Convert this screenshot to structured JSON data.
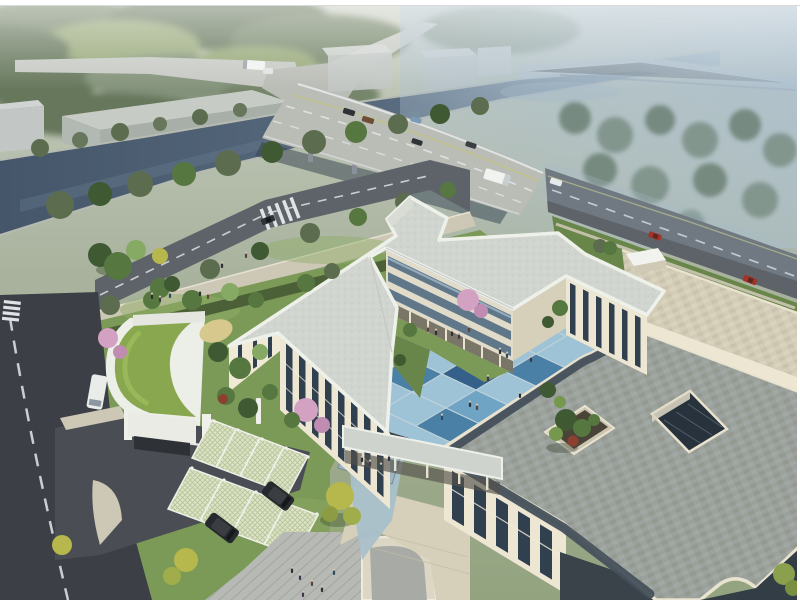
{
  "image": {
    "kind": "architectural aerial rendering",
    "description": "Bird's-eye perspective rendering of a three-story cream campus building with a blue checkerboard courtyard, grey paved roofs with skylight atrium and rooftop planter, curved green-roof gatehouse, grass-grid parking, beside a canal crossed by a curving boulevard bridge; misty trees and a distant viaduct fill the background.",
    "width_px": 800,
    "height_px": 600
  },
  "palette": {
    "fogTop": "#ccd2c5",
    "fogLow": "#a7b19c",
    "fieldFar": "#97a878",
    "treeFar1": "#76866b",
    "treeFar2": "#66775c",
    "treeFar3": "#83927a",
    "hazeBlue": "#a9bdcc",
    "treeHazy1": "#71857a",
    "treeHazy2": "#7e9289",
    "canal": "#45566a",
    "canalFar": "#8fa6b8",
    "bankStone": "#b6bbb2",
    "deck": "#babcb6",
    "deckFar": "#c6c9c3",
    "roadMid": "#5e636a",
    "roadLeft": "#3c4046",
    "laneWhite": "#e4e8ea",
    "laneYellow": "#c6c67c",
    "viaduct": "#bac5cc",
    "underBridge": "#323f4d",
    "warehouseRoof": "#c7cbc5",
    "warehouseSide": "#a8aea8",
    "warehouseEnd": "#b2b8b2",
    "cube": "#c2c7c5",
    "crosswalk": "#dfe3e5",
    "sidewalk": "#cdc7b5",
    "curb": "#e6e1d3",
    "hedge": "#4b6037",
    "lawn": "#7c9a57",
    "lawnLight": "#8fad67",
    "lawnDark": "#68854a",
    "treeDark": "#3f5a33",
    "treeMid": "#567740",
    "treeLight": "#86a964",
    "treeOlive": "#5c6d4f",
    "treeYellow": "#b6b84e",
    "pink1": "#d3a2c2",
    "pink2": "#c18cb1",
    "shrubRed": "#8e4030",
    "greenRoof": "#89a74e",
    "greenRoofHi": "#9ebf5e",
    "gatehouseWhite": "#eceee8",
    "sand": "#d7c88e",
    "latBase": "#dde3c8",
    "latGrid": "#b7c598",
    "post": "#f0f0ea",
    "drive": "#4a4e54",
    "roofNorth": "#d1d5cf",
    "fascia": "#eef0ea",
    "wallLit": "#ece6d3",
    "wallWarm": "#efe9d6",
    "wallCool": "#e1dbca",
    "wallShade": "#d6d0bb",
    "winDark": "#31404f",
    "winBand": "#5a7287",
    "winLite": "#b9d0dd",
    "colShadow": "#6f6a5c",
    "roofGray": "#9ba19c",
    "slate": "#46505b",
    "parapet": "#e8e2cf",
    "tanRoof": "#d3cdb8",
    "atrium": "#27323c",
    "mullion": "#5d6d78",
    "tilePale": "#9fc3d6",
    "tileLight": "#6fa4c4",
    "tileMid": "#4a80a6",
    "tileDark": "#35608a",
    "grout": "#c3d3da",
    "pathBlue": "#a9c0ca",
    "plaza": "#b7bab4",
    "plank": "#a9aca7",
    "tanPlaza": "#d6cfba",
    "carRed": "#a23527",
    "carDark": "#2e3338",
    "carBlue": "#7a9ab5",
    "carBrown": "#6f4e36",
    "vanWhite": "#eaecea",
    "suv": "#26292d",
    "busWhite": "#f1f3f1",
    "person": "#2b2f33",
    "personHead": "#cfc4b4",
    "frame": "#ffffff",
    "darkFacade": "#333d45"
  },
  "scene": {
    "atmosphere": "morning mist, grey-green haze upper-left, blue haze upper-right",
    "waterway": {
      "type": "canal",
      "runs": "from left edge diagonally to upper right, passing under two bridges"
    },
    "bridges": [
      {
        "name": "boulevard-bridge",
        "lanes": 6,
        "markings": [
          "white edge lines",
          "dashed lane lines",
          "yellow centre line"
        ]
      },
      {
        "name": "distant-viaduct",
        "appearance": "hazy elevated ramp, top right"
      }
    ],
    "roads": {
      "top-service-road": "tree-lined road north of canal with white bus",
      "front-arterial": "diagonal road in front of site with zebra crossing and dark sedan",
      "east-road": "continuation past site with two red cars",
      "left-street": "vertical two-lane street with dashed centre line, white van, zebra crossing"
    },
    "buildings": {
      "north-block": {
        "floors": 3,
        "roof": "pale speckled slab with rooftop notch",
        "facades": "cream with vertical window strips; courtyard face has ribbon windows over a colonnade"
      },
      "south-block": {
        "roof": "grey block pavers with dark slate trim and rounded corners",
        "features": [
          "square skylight atrium",
          "rooftop terrace planter with trees and red shrub",
          "raised tan-paved section with penthouse box",
          "link walkway to north block"
        ]
      },
      "gatehouse": {
        "roof": "curved green grass roof",
        "features": [
          "entrance canopy",
          "barrier gate with white pillars",
          "sand patch"
        ]
      },
      "warehouse": "long grey shed across the canal",
      "distant-cubes": 3
    },
    "courtyard": {
      "paving": "checkerboard of blue tiles in four shades",
      "extras": [
        "lawn borders",
        "pink blossom tree",
        "people walking"
      ]
    },
    "site": {
      "parking": {
        "type": "grass-grid paver stalls in two rows",
        "parked": "2 black SUVs",
        "bollards": "white posts"
      },
      "plazas": [
        "small blue seating square with benches",
        "timber-plank plaza with people",
        "stone plaza by south facade"
      ],
      "landscape": "dense garden trees incl. pink blossoms and yellow-green trees, hedges, street trees"
    },
    "counts": {
      "people": 32,
      "vehicles": 16,
      "courtyard_tiles": 15
    }
  }
}
